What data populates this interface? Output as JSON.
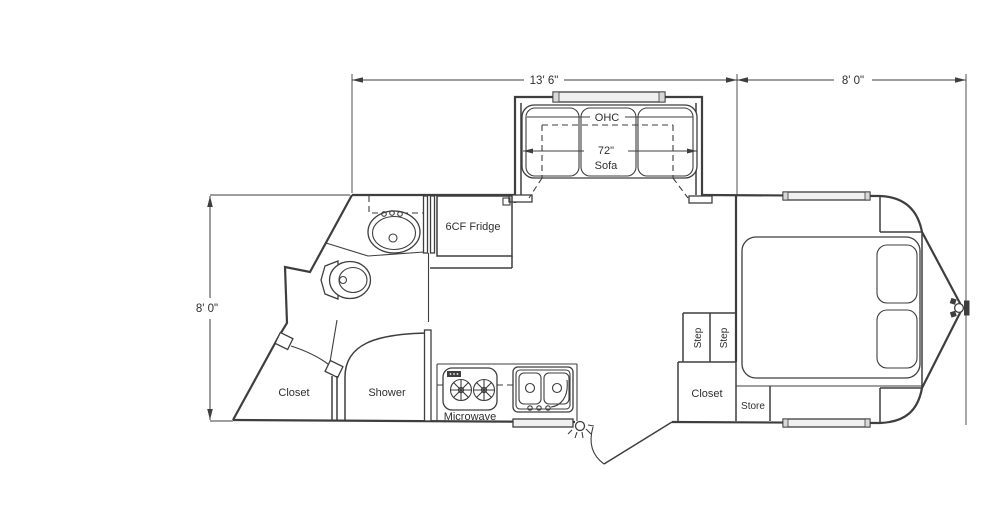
{
  "drawing": {
    "type": "travel-trailer floor plan",
    "line_color": "#3e3e3e",
    "background": "#ffffff"
  },
  "dimensions": {
    "main_length": "13' 6\"",
    "front_length": "8' 0\"",
    "width": "8' 0\""
  },
  "labels": {
    "ohc": "OHC",
    "sofa_width": "72\"",
    "sofa": "Sofa",
    "fridge": "6CF Fridge",
    "microwave": "Microwave",
    "shower": "Shower",
    "closet_rear": "Closet",
    "closet_bedroom": "Closet",
    "step_1": "Step",
    "step_2": "Step",
    "store": "Store"
  }
}
